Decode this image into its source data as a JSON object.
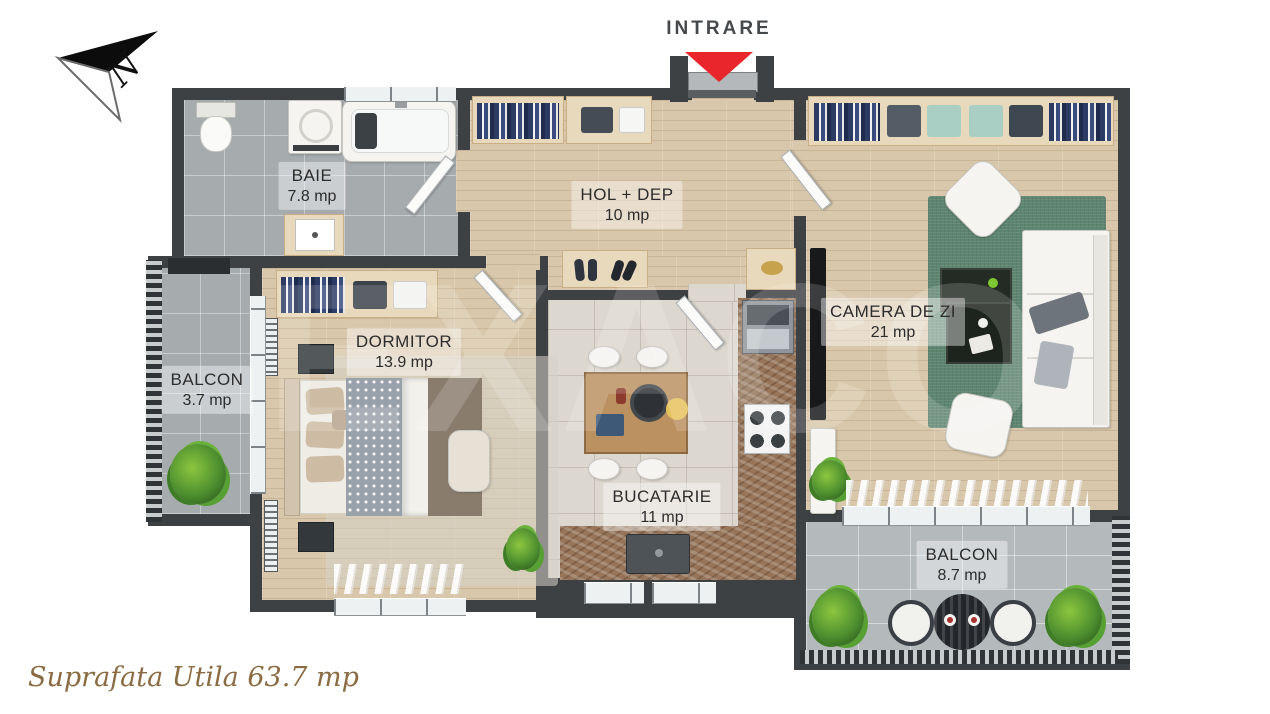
{
  "compass": {
    "label": "N"
  },
  "entrance": {
    "label": "INTRARE",
    "arrow_color": "#e8262b"
  },
  "rooms": {
    "baie": {
      "name": "BAIE",
      "area": "7.8 mp"
    },
    "hol": {
      "name": "HOL + DEP",
      "area": "10 mp"
    },
    "camera_de_zi": {
      "name": "CAMERA DE ZI",
      "area": "21 mp"
    },
    "balcon_left": {
      "name": "BALCON",
      "area": "3.7 mp"
    },
    "dormitor": {
      "name": "DORMITOR",
      "area": "13.9 mp"
    },
    "bucatarie": {
      "name": "BUCATARIE",
      "area": "11 mp"
    },
    "balcon_bottom": {
      "name": "BALCON",
      "area": "8.7 mp"
    }
  },
  "footer": {
    "total_area_label": "Suprafata Utila 63.7 mp"
  },
  "watermark": {
    "text": "EXACO"
  },
  "colors": {
    "wall": "#3e4144",
    "entrance_arrow": "#e8262b",
    "footer_text": "#8a6b42",
    "wood_floor": "#d9c7ab",
    "gray_tile": "#a6abae",
    "green_rug": "#5d8570",
    "counter": "#96755a"
  }
}
